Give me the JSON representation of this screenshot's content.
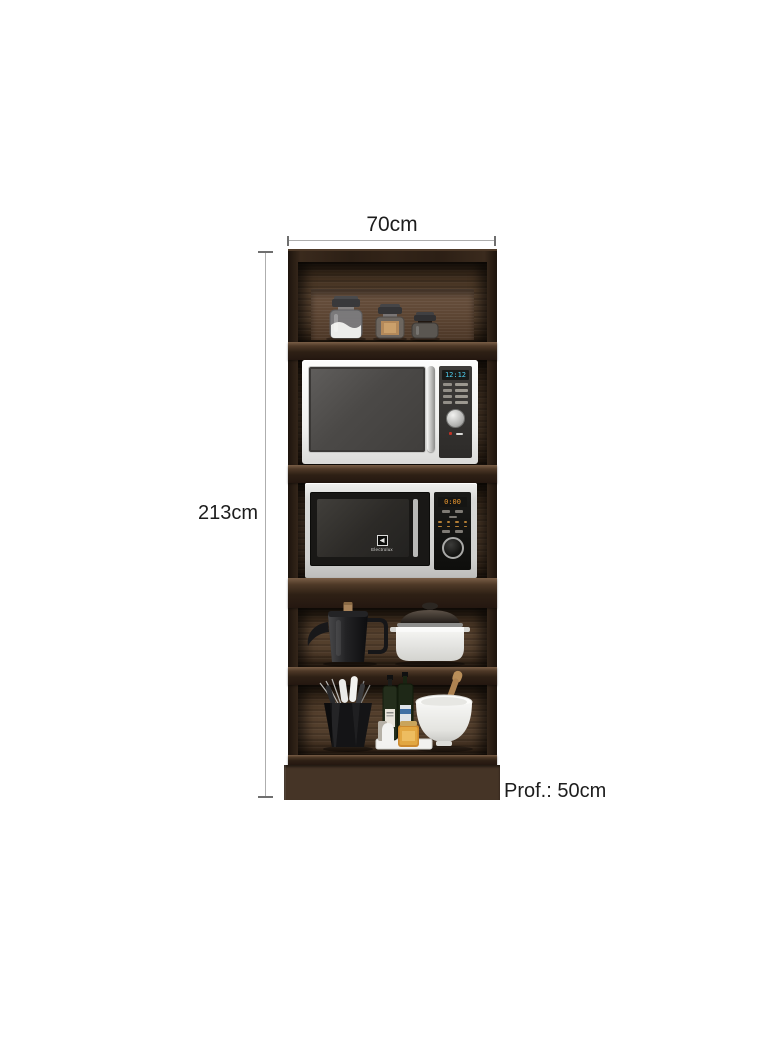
{
  "dimensions": {
    "width_label": "70cm",
    "height_label": "213cm",
    "depth_label": "Prof.: 50cm"
  },
  "cabinet": {
    "microwave_top": {
      "display_value": "12:12"
    },
    "microwave_bottom": {
      "display_value": "0:00",
      "brand": "Electrolux"
    }
  },
  "colors": {
    "background": "#ffffff",
    "wood_frame": "#2c1f15",
    "wood_interior": "#55402d",
    "dimension_line": "#aeaeae",
    "dimension_text": "#1d1d1d",
    "display_cyan": "#4ecdee",
    "display_orange": "#ee9a30"
  }
}
